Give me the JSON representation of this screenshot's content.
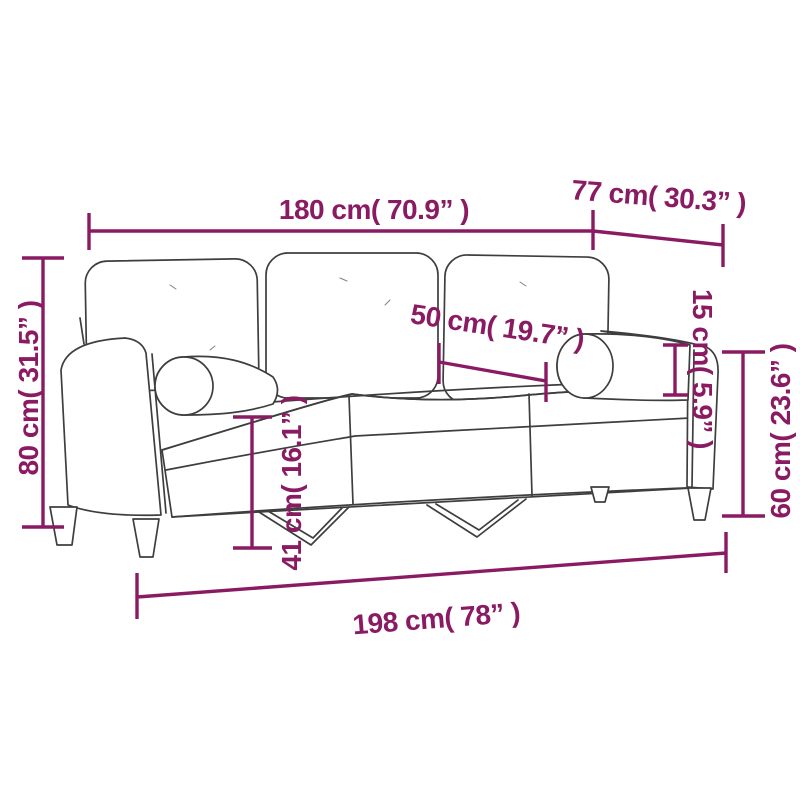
{
  "diagram": {
    "kind": "product-dimension-line-drawing",
    "subject": "three-seater-sofa-with-bolster-pillows",
    "colors": {
      "dimension_accent": "#8A1B63",
      "drawing_line": "#3E3E3E",
      "background": "#FFFFFF"
    },
    "measurements": {
      "seat_span_top": {
        "label": "180 cm( 70.9” )"
      },
      "depth_top": {
        "label": "77 cm( 30.3” )"
      },
      "overall_height_left": {
        "label": "80 cm( 31.5” )"
      },
      "seat_cushion_width": {
        "label": "50 cm( 19.7” )"
      },
      "bolster_diameter": {
        "label": "15 cm( 5.9” )"
      },
      "arm_height_right": {
        "label": "60 cm( 23.6” )"
      },
      "seat_height": {
        "label": "41 cm( 16.1” )"
      },
      "overall_width_bottom": {
        "label": "198 cm( 78” )"
      }
    }
  }
}
